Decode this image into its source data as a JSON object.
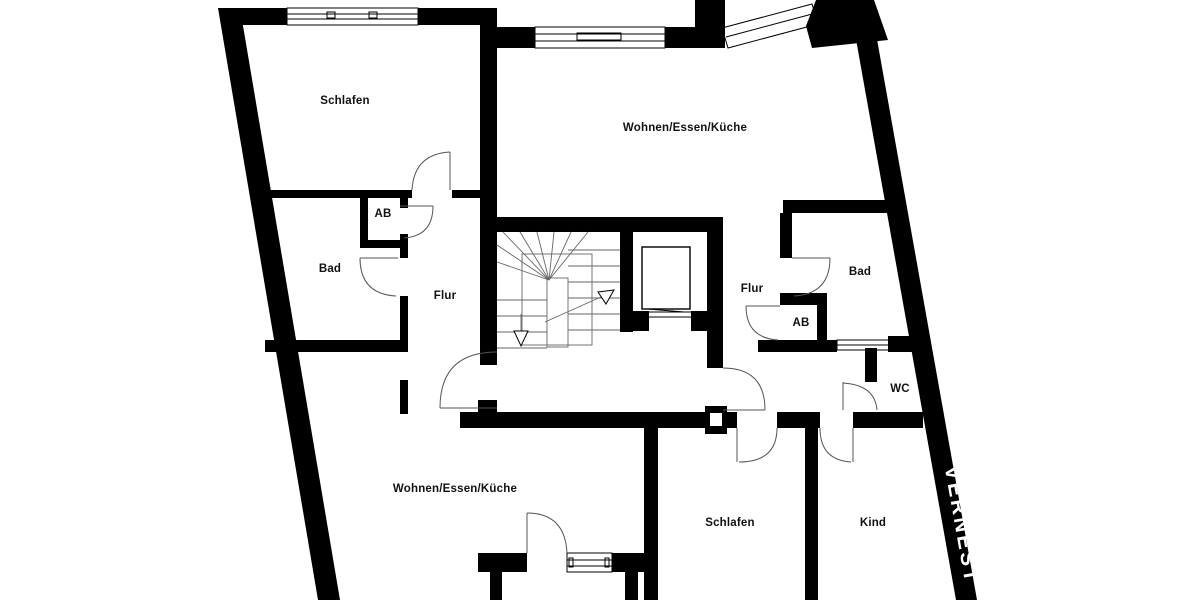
{
  "colors": {
    "wall": "#000000",
    "background": "#ffffff",
    "watermark_text": "#ffffff"
  },
  "watermark": {
    "text": "VERNEST"
  },
  "rooms": {
    "apt_left": {
      "schlafen": "Schlafen",
      "ab": "AB",
      "bad": "Bad",
      "flur": "Flur",
      "wohnen": "Wohnen/Essen/Küche"
    },
    "apt_right": {
      "wohnen": "Wohnen/Essen/Küche",
      "flur": "Flur",
      "bad": "Bad",
      "ab": "AB",
      "wc": "WC",
      "schlafen": "Schlafen",
      "kind": "Kind"
    }
  }
}
